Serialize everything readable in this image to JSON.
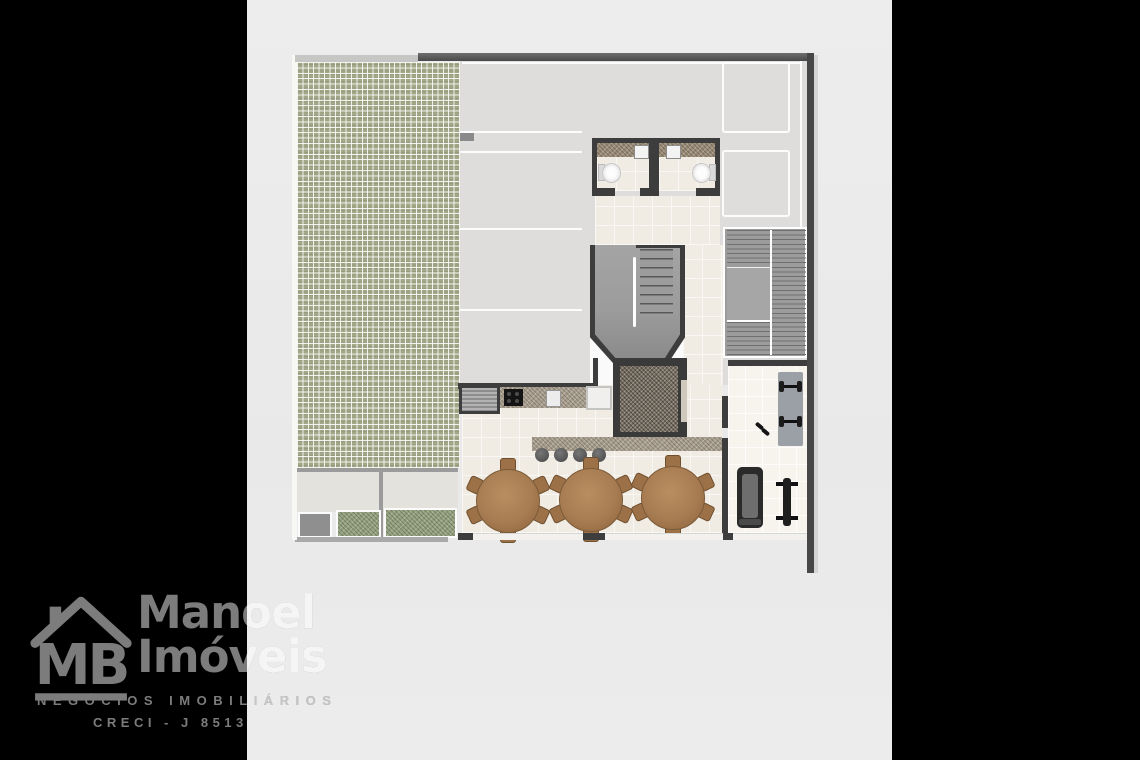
{
  "branding": {
    "monogram": "MB",
    "name_line1": "Manoel",
    "name_line2": "Imóveis",
    "tagline": "NEGÓCIOS IMOBILIÁRIOS",
    "registration": "CRECI - J 8513"
  },
  "colors": {
    "letterbox": "#000000",
    "canvas": "#ebebeb",
    "wall": "#3d3d3d",
    "paver_green": "#a2a787",
    "garage_floor": "#dedddc",
    "tile_floor": "#f0ebe3",
    "stair_gray": "#9c9c9c",
    "granite_counter": "#a89e8e",
    "elevator_core": "#776d60",
    "table_wood": "#a87c52",
    "watermark_on_black": "#7c7c7c",
    "watermark_on_light": "#f5f5f5"
  }
}
